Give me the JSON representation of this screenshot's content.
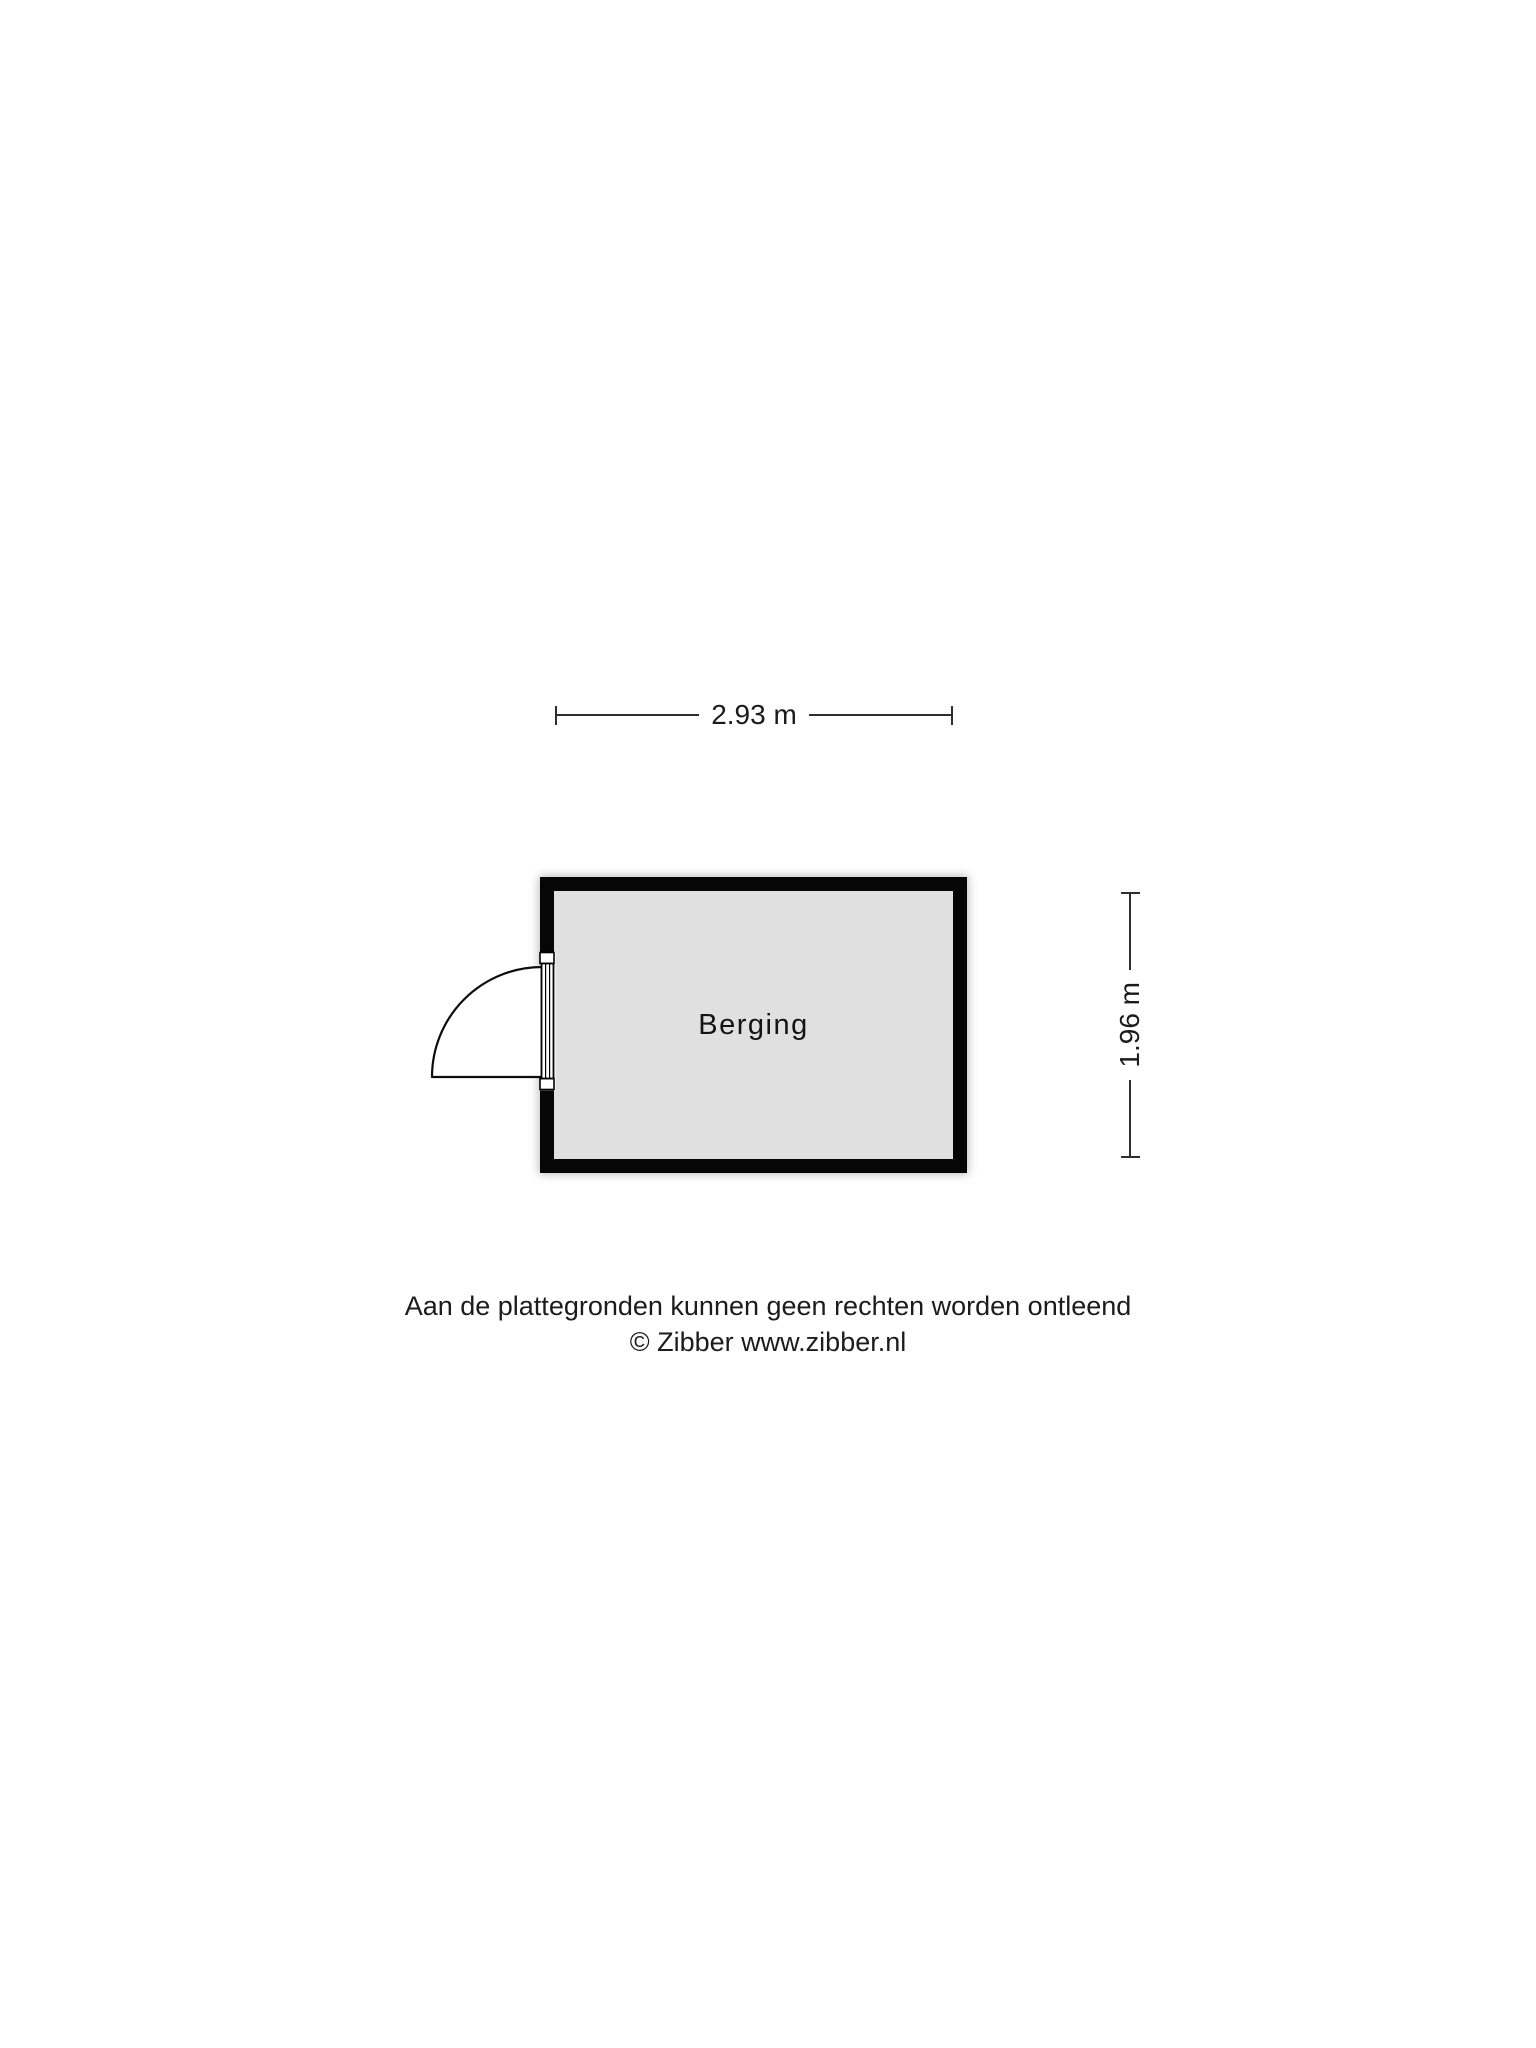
{
  "floorplan": {
    "room": {
      "label": "Berging",
      "fill_color": "#e0e0e0",
      "wall_color": "#060606"
    },
    "dimensions": {
      "width_label": "2.93 m",
      "height_label": "1.96 m"
    },
    "door": {
      "type": "single-swing-door",
      "wall_side": "left"
    },
    "disclaimer": {
      "line1": "Aan de plattegronden kunnen geen rechten worden ontleend",
      "line2": "© Zibber www.zibber.nl"
    },
    "colors": {
      "background": "#ffffff",
      "dimension_line": "#2e2e2e",
      "text": "#1b1b1b"
    }
  }
}
